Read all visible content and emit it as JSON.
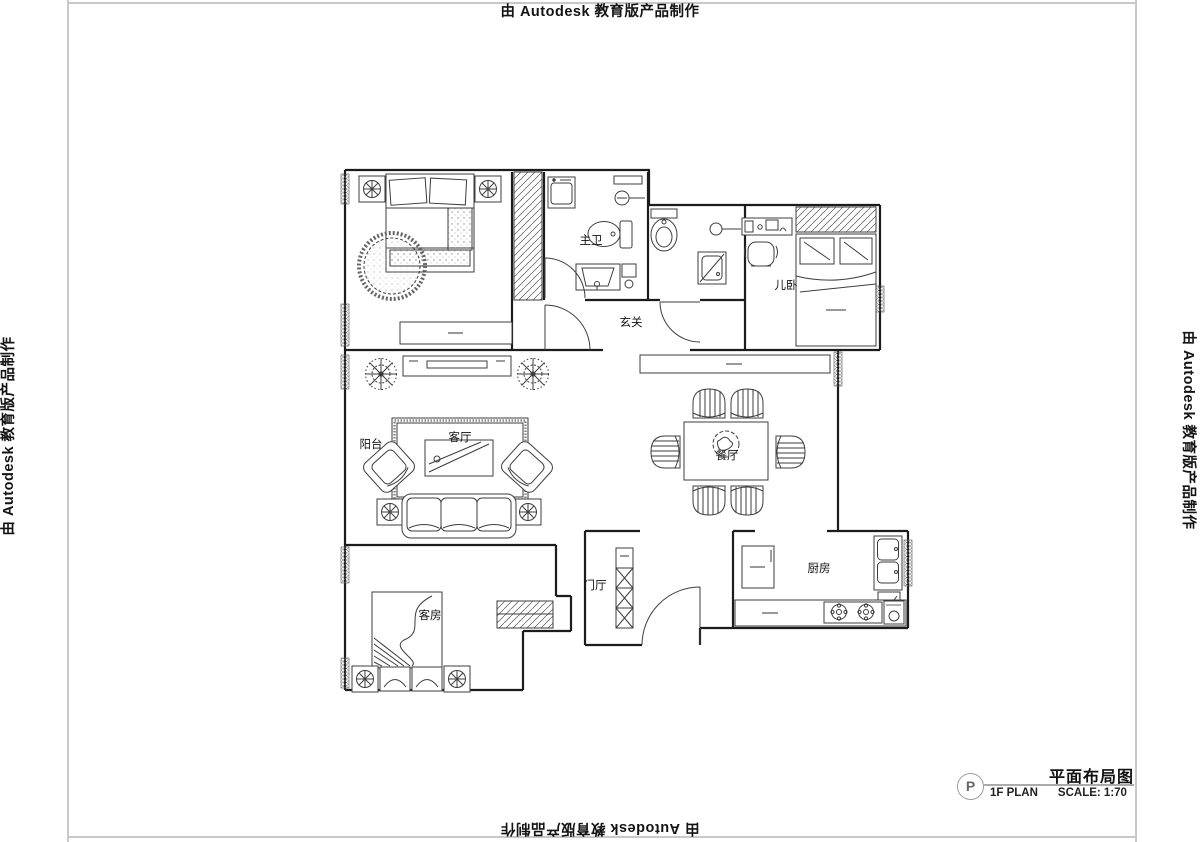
{
  "watermark": {
    "text": "由 Autodesk 教育版产品制作"
  },
  "title_block": {
    "detail_mark": "P",
    "title": "平面布局图",
    "plan_label": "1F PLAN",
    "scale_label": "SCALE: 1:70"
  },
  "rooms": {
    "master_bath": "主卫",
    "entry_hall": "玄关",
    "kids_bedroom": "儿卧",
    "living_room": "客厅",
    "balcony": "阳台",
    "dining_room": "餐厅",
    "foyer": "门厅",
    "kitchen": "厨房",
    "guest_room": "客房"
  },
  "colors": {
    "wall": "#1c1c1c",
    "furniture_line": "#3d3d3d",
    "border_line": "#c8c8c8",
    "label_text": "#111111"
  }
}
